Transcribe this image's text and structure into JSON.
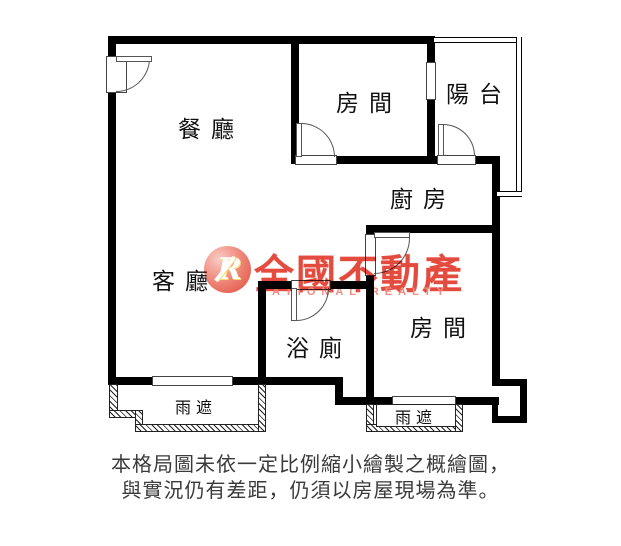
{
  "plan": {
    "rooms": {
      "dining": "餐廳",
      "bedroom_top": "房間",
      "balcony": "陽台",
      "kitchen": "廚房",
      "living": "客廳",
      "bathroom": "浴廁",
      "bedroom_right": "房間",
      "canopy_left": "雨遮",
      "canopy_right": "雨遮"
    }
  },
  "watermark": {
    "logo_letter": "R",
    "brand": "全國不動產",
    "brand_en": "NATIONAL REALTY",
    "color": "#e23b2e"
  },
  "disclaimer": {
    "line1": "本格局圖未依一定比例縮小繪製之概繪圖，",
    "line2": "與實況仍有差距，仍須以房屋現場為準。"
  },
  "colors": {
    "wall": "#000000",
    "thin_line": "#444444",
    "body_text": "#3a3a3a",
    "watermark_red": "#e23b2e",
    "watermark_pink": "#ef8276"
  }
}
